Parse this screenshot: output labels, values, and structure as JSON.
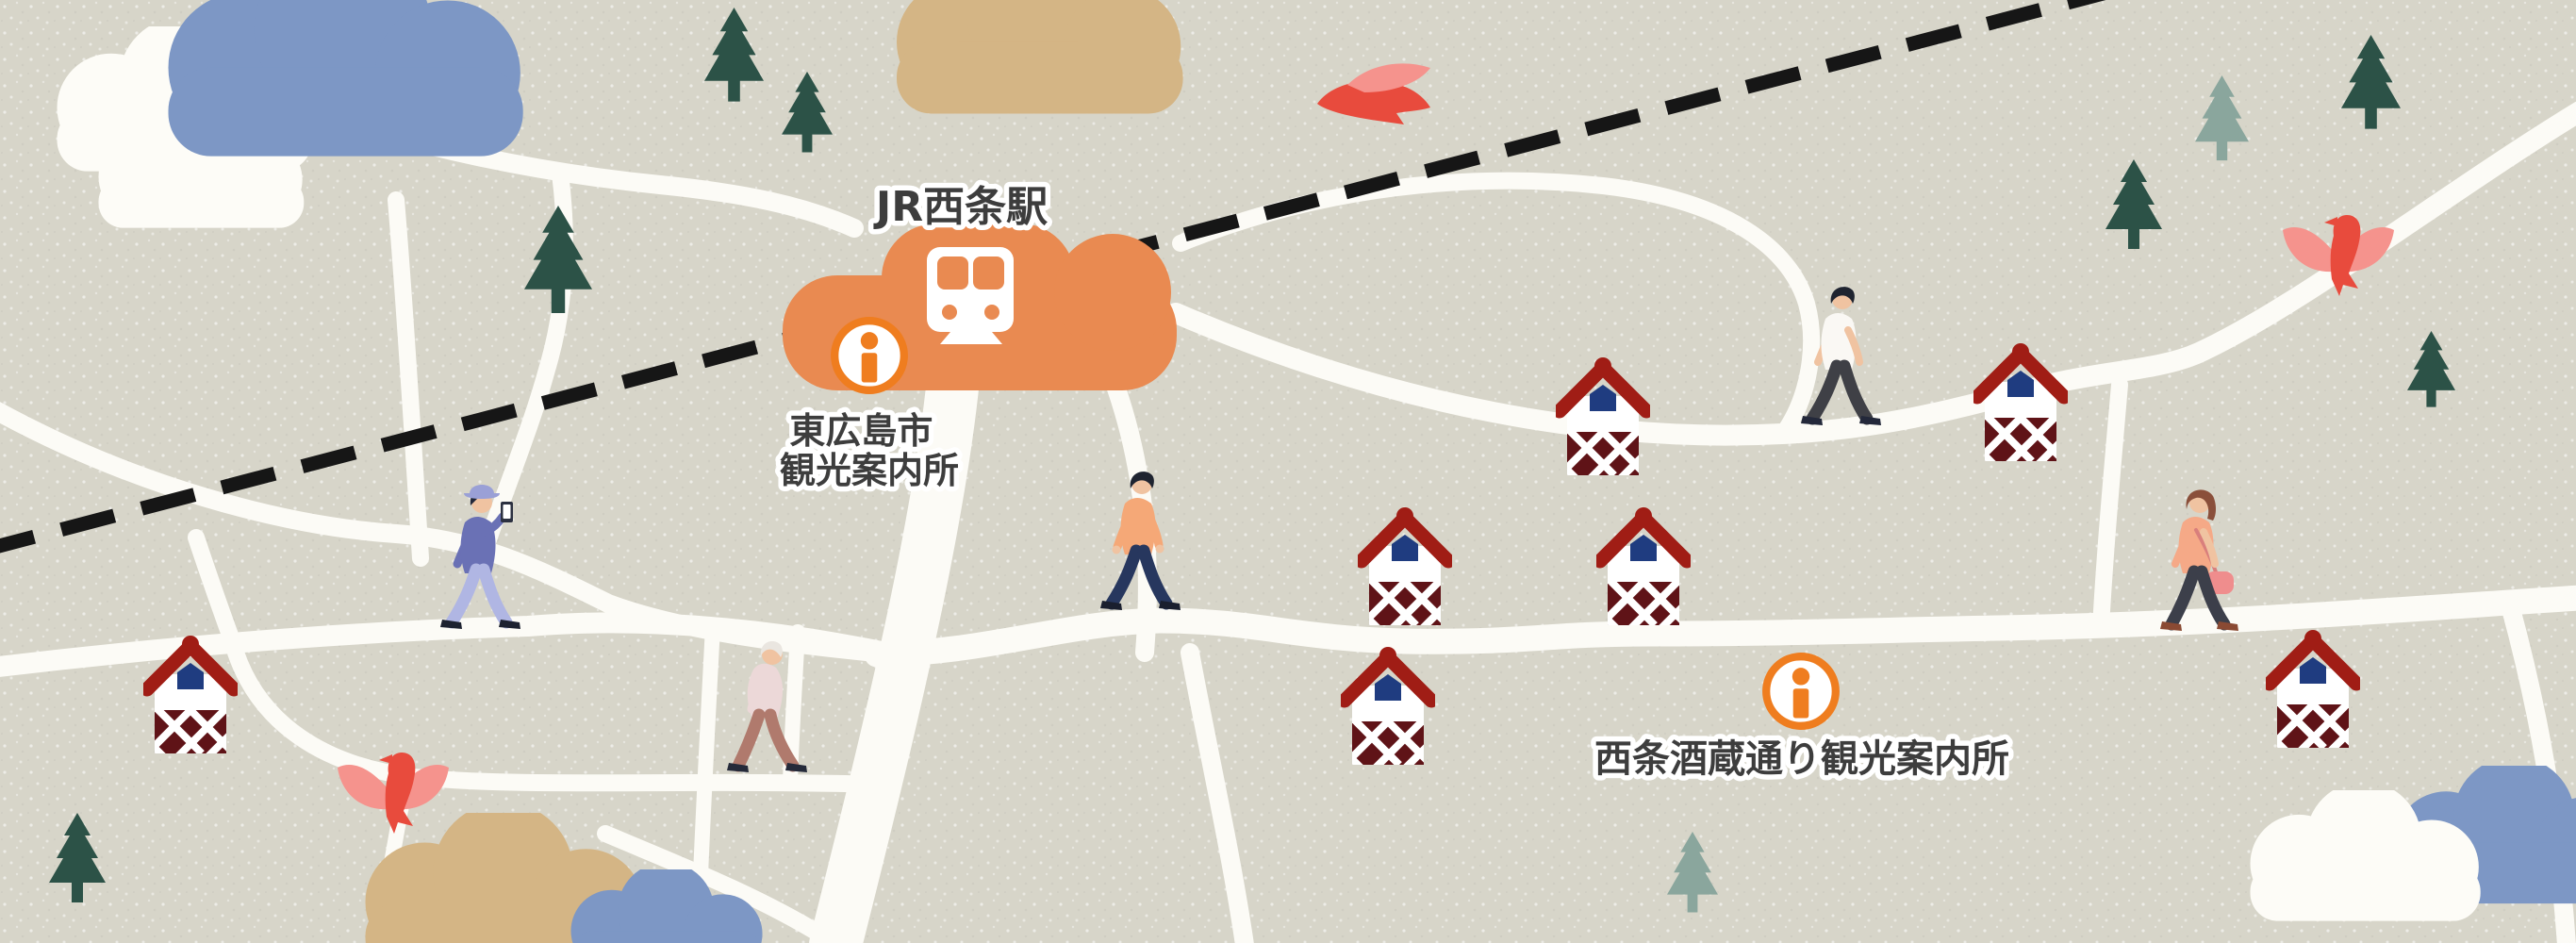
{
  "theme": {
    "background": "#d7d5c9",
    "road": "#fcfbf6",
    "railway": "#161616",
    "station-orange": "#e98a51",
    "accent-orange": "#ef7d1f",
    "label-text": "#3d3d3d",
    "label-outline": "#ffffff",
    "tree-dark": "#2c5247",
    "tree-light": "#8aa69d",
    "cloud-blue": "#7d97c5",
    "cloud-white": "#fdfcf7",
    "cloud-tan": "#d4b585",
    "brewery-roof": "#a01d15",
    "brewery-wall": "#5f1317",
    "brewery-window": "#1f3c80",
    "brewery-body": "#ffffff",
    "bird-red": "#e84b3d",
    "bird-pink": "#f5938d"
  },
  "map": {
    "station": {
      "name": "JR西条駅",
      "icon": "train-front-icon"
    },
    "info_centers": [
      {
        "name": "東広島市観光案内所",
        "name_lines": [
          "東広島市",
          "観光案内所"
        ],
        "icon": "info-icon"
      },
      {
        "name": "西条酒蔵通り観光案内所",
        "name_lines": [
          "西条酒蔵通り観光案内所"
        ],
        "icon": "info-icon"
      }
    ],
    "poi_counts": {
      "sake_breweries": 7,
      "people": 5,
      "birds": 3,
      "trees": 9,
      "clouds": 7
    }
  },
  "people": [
    {
      "id": "man-with-phone",
      "colors": {
        "skin": "#f0c3a1",
        "hair": "#23283a",
        "hat": "#9aa0d6",
        "top": "#6a71b5",
        "pants": "#b0b6e3",
        "shoes": "#1d2230",
        "phone_body": "#2b3040",
        "phone_screen": "#ffffff"
      }
    },
    {
      "id": "elderly-man",
      "colors": {
        "skin": "#f0c3a1",
        "hair": "#eae6e0",
        "top": "#ecd8d8",
        "pants": "#b07a6d",
        "shoes": "#252a3a"
      }
    },
    {
      "id": "man-peach-shirt",
      "colors": {
        "skin": "#f0c3a1",
        "hair": "#1f2430",
        "top": "#f5a877",
        "pants": "#27375e",
        "shoes": "#1a1f2e"
      }
    },
    {
      "id": "man-white-shirt",
      "colors": {
        "skin": "#f0c3a1",
        "hair": "#1f2430",
        "top": "#faf8f4",
        "pants": "#3f4046",
        "shoes": "#23283a"
      }
    },
    {
      "id": "woman-with-bag",
      "colors": {
        "skin": "#f0c3a1",
        "hair": "#8a4f3a",
        "top": "#f5a987",
        "pants": "#3c3f4a",
        "shoes": "#8a4a33",
        "bag": "#ef8d8d",
        "strap": "#d97f7c"
      }
    }
  ]
}
